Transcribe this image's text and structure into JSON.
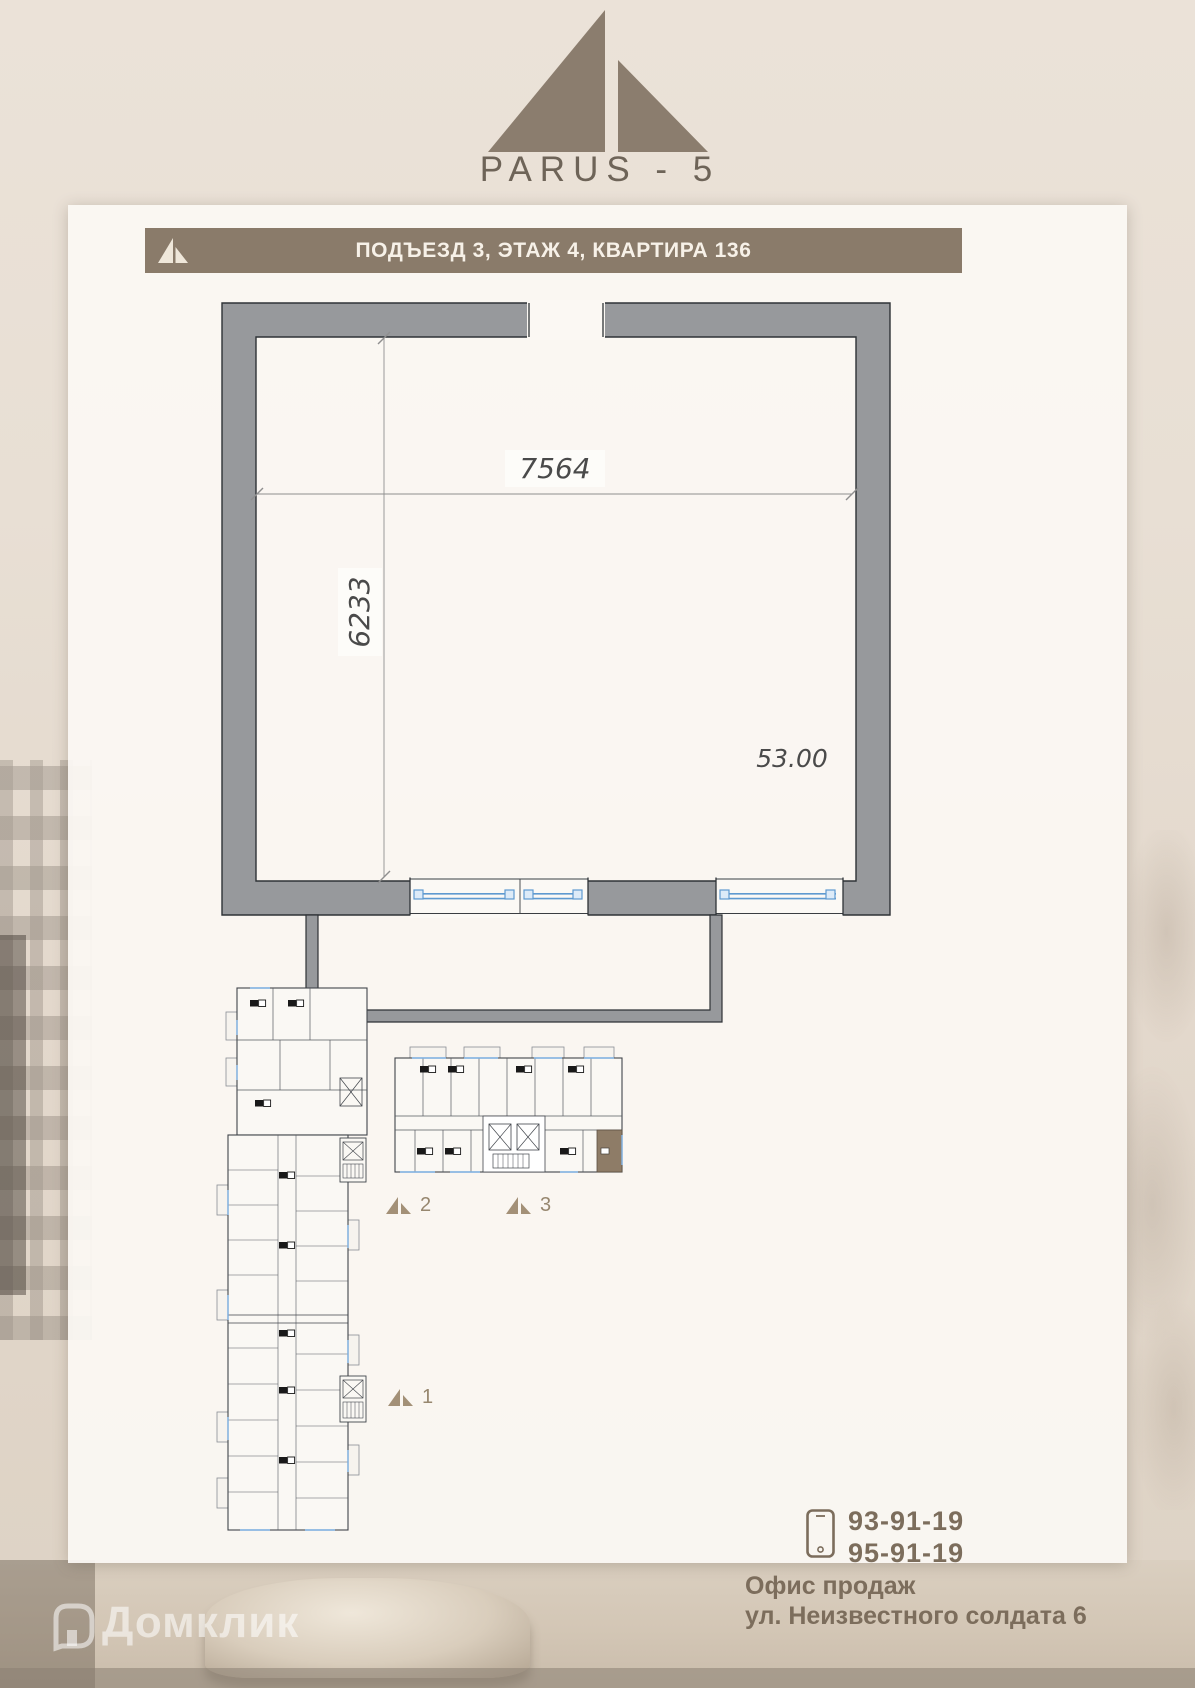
{
  "logo": {
    "title": "PARUS - 5"
  },
  "header": {
    "title": "ПОДЪЕЗД 3, ЭТАЖ 4, КВАРТИРА 136"
  },
  "plan": {
    "width_mm": "7564",
    "depth_mm": "6233",
    "area": "53.00"
  },
  "site": {
    "markers": [
      {
        "label": "2"
      },
      {
        "label": "3"
      },
      {
        "label": "1"
      }
    ]
  },
  "contact": {
    "phone1": "93-91-19",
    "phone2": "95-91-19",
    "office": "Офис продаж",
    "address": "ул. Неизвестного солдата 6"
  },
  "watermark": {
    "text": "Домклик"
  },
  "colors": {
    "accent_taupe": "#8a7b6a",
    "wall_gray": "#97999c",
    "window_blue": "#6ba2d8",
    "highlight_unit": "#8e7c67",
    "sheet_white": "#fbf8f3"
  }
}
